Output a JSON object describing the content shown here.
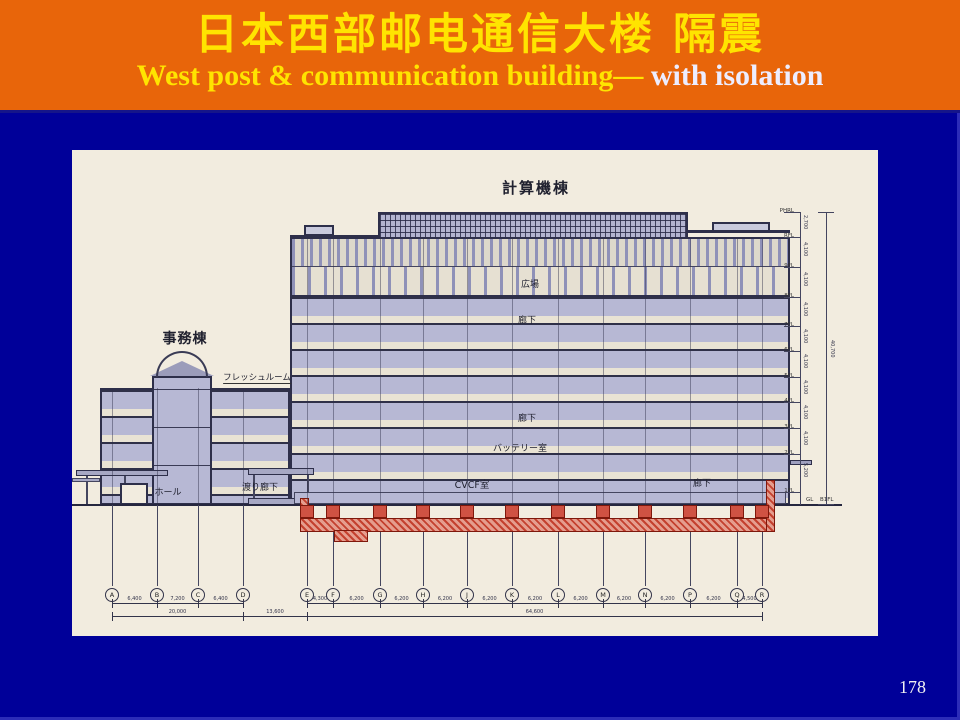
{
  "slide": {
    "title_cn": "日本西部邮电通信大楼  隔震",
    "subtitle_main": "West post & communication building—",
    "subtitle_accent": " with isolation",
    "page_number": "178"
  },
  "colors": {
    "background": "#000099",
    "header_orange": "#E8650A",
    "title_yellow": "#FFE400",
    "subtitle_white": "#EDEDFF",
    "paper": "#F2ECDF",
    "wall_lavender": "#B7B8D4",
    "isolation_red": "#C4412F",
    "line_dark": "#2E2F4A"
  },
  "drawing": {
    "labels": {
      "computer_building": "計算機棟",
      "office_building": "事務棟",
      "fresh_room": "フレッシュルーム",
      "plaza": "広場",
      "corridor_upper": "廊下",
      "corridor_mid": "廊下",
      "corridor_right": "廊下",
      "battery_room": "バッテリー室",
      "cvcf_room": "CVCF室",
      "hall": "ホール",
      "connecting_corridor": "渡り廊下"
    },
    "grid": {
      "letters": [
        "A",
        "B",
        "C",
        "D",
        "E",
        "F",
        "G",
        "H",
        "J",
        "K",
        "L",
        "M",
        "N",
        "P",
        "Q",
        "R"
      ],
      "dims_left": [
        "6,400",
        "7,200",
        "6,400"
      ],
      "total_left": "20,000",
      "gap_dim": "13,600",
      "dims_right": [
        "4,300",
        "6,200",
        "6,200",
        "6,200",
        "6,200",
        "6,200",
        "6,200",
        "6,200",
        "6,200",
        "6,200",
        "4,500"
      ],
      "total_right": "64,600"
    },
    "levels": {
      "labels": [
        "PHRL",
        "RFL",
        "9FL",
        "8FL",
        "7FL",
        "6FL",
        "5FL",
        "4FL",
        "3FL",
        "2FL",
        "1FL"
      ],
      "story_dims": [
        "2,700",
        "4,100",
        "4,100",
        "4,100",
        "4,100",
        "4,100",
        "4,100",
        "4,100",
        "4,100",
        "5,200"
      ],
      "ground": "GL",
      "basement": "B1FL",
      "total_height": "40,700"
    }
  }
}
